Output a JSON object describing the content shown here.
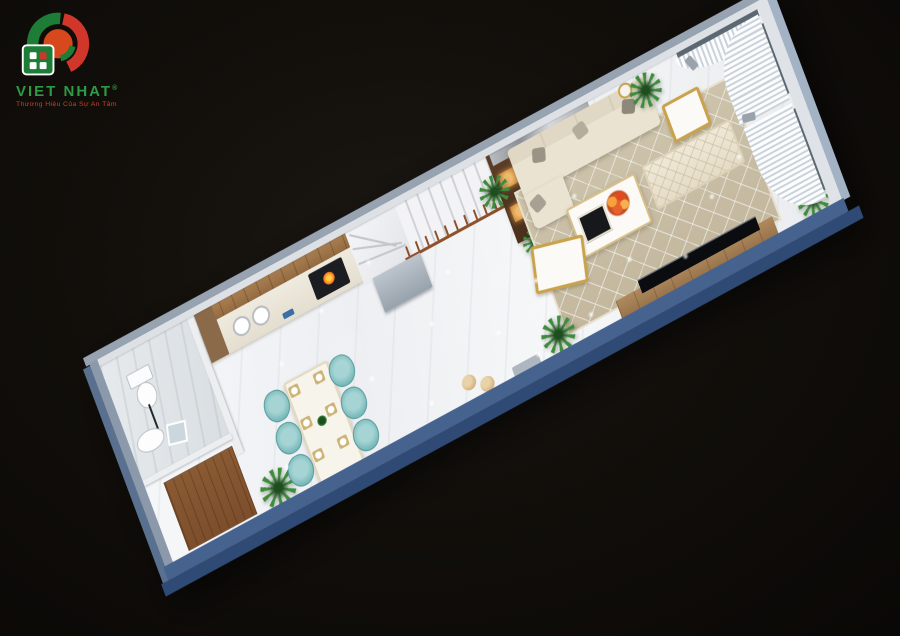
{
  "brand": {
    "name": "VIET NHAT",
    "registered": "®",
    "tagline": "Thương Hiệu Của Sự An Tâm",
    "logo_colors": {
      "green": "#1d7c36",
      "red": "#d0372a",
      "inner_orange": "#d8481d"
    }
  },
  "scene": {
    "type": "3d-floor-plan-top-view-render",
    "description_colors": {
      "background": "#0e0c0a",
      "exterior_wall_blue": "#46628e",
      "exterior_wall_blue_dark": "#2e4a75",
      "floor_marble": "#f2f4f6",
      "rug_beige": "#cbc1a8",
      "sofa_cream": "#eae3d2",
      "kitchen_wood": "#a87e50",
      "stair_rail_wood": "#8e4f2b",
      "dining_chair_teal": "#77b8b9",
      "plant_green": "#3f8d3c",
      "accent_gold": "#c9a24b",
      "burner_orange": "#ff7d1f"
    },
    "rooms": [
      {
        "name": "Bathroom",
        "items": [
          "toilet",
          "washbasin",
          "mirror"
        ]
      },
      {
        "name": "Back entry",
        "items": [
          "wooden mat",
          "palm plant"
        ]
      },
      {
        "name": "Kitchen",
        "items": [
          "wall cabinets",
          "counter with double sink",
          "cooktop",
          "dish shelf"
        ]
      },
      {
        "name": "Dining area",
        "items": [
          "white dining table",
          "6 teal chairs",
          "6 place settings",
          "centerpiece plant"
        ]
      },
      {
        "name": "Staircase",
        "items": [
          "marble winder steps",
          "wood handrail",
          "under-stair cabinet",
          "lit display shelf"
        ]
      },
      {
        "name": "Living room",
        "items": [
          "cream sofa",
          "gray pillows",
          "gold stool",
          "coffee table with orange flowers",
          "geometric area rug",
          "tufted daybed",
          "gold bench",
          "TV console",
          "TV",
          "palm plants",
          "poufs"
        ]
      },
      {
        "name": "Front window wall",
        "items": [
          "glass windows",
          "draped white curtains",
          "curtain tiebacks"
        ]
      }
    ]
  }
}
